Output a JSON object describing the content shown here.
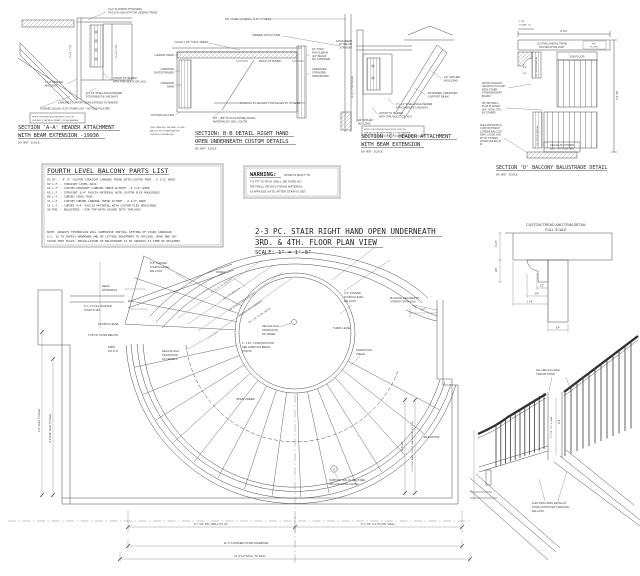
{
  "colors": {
    "ink": "#3f3f3f",
    "paper": "#ffffff"
  },
  "sa": {
    "t1": "SECTION 'A-A' HEADER ATTACHMENT",
    "t2": "WITH BEAM EXTENSION -19936",
    "scale": "DO NOT SCALE",
    "flooring": [
      "3-1/4\" FLOORING THICKNESS",
      "THIS IS FLUSH WITH TOP LANDING TREAD"
    ],
    "molding": [
      "1 1/2\" APPLIED",
      "MOLDING"
    ],
    "attach": [
      "ATTACH TO HEADER",
      "WITH THRU BOLTS OR LAGS"
    ],
    "angle": [
      "2\" x 1/4\" STEEL ANGLE HEADER",
      "ATTACHMENT BY ARCWAYS"
    ],
    "beam": "LAMINATED SUPPORT BEAM EXTENDS TO HEADER",
    "ceiling": "FINISHED CEILING IS BY OTHERS (3/4\" - 5/8\" PLUS PLASTER)",
    "note": [
      "NOTE: PROVIDE ACCESS AT FLOOR OR",
      "CEILING TO ATTACH STAIR TO THE HEADER"
    ],
    "dim1": "16 1/4\" (TYP)",
    "dim2": "15 1/2\" (TYP)"
  },
  "sb": {
    "t1": "SECTION: B-B DETAIL RIGHT HAND",
    "t2": "OPEN UNDERNEATH CUSTOM DETAILS",
    "scale": "DO NOT SCALE",
    "fin_panel": "FIN. PANEL MATERIAL IS BY OTHERS",
    "veneer": "VENEER TOP NO TRIM",
    "solid": "SOLID 1 1/4\" THICK TREAD",
    "back": "BACK OF RISER",
    "furring": "FURRING BY ARCWAYS INSTALLED BY OTHERS",
    "plaster": [
      "3/4\" - (5/8\" PLUS PLASTER) FINISH",
      "MATERIAL BY GEN. CONTR."
    ],
    "landing": "LANDING TREAD",
    "skirt": [
      "LAMINATED",
      "SKIRT/STRINGER"
    ],
    "beam": [
      "LAMINATED",
      "BEAM"
    ],
    "flex": "CUSTOM FLEX TRIM",
    "loose": [
      "THIS TRIM WILL BE SENT LOOSE",
      "AND FIT BY OTHERS AFTER",
      "CEILING IS INSTALLED"
    ],
    "fascia": [
      "3/4\" THICK",
      "FASCIA BEAM",
      "(1/2\" BELOW",
      "FIN. STRINGER)"
    ],
    "stringer": [
      "LAMINATED",
      "STRINGER/",
      "SKIRTBOARD"
    ]
  },
  "sc": {
    "t1": "SECTION 'C' HEADER ATTACHMENT",
    "t2": "WITH BEAM EXTENSION",
    "scale": "DO NOT SCALE",
    "fascia": [
      "FASCIA BEAM",
      "1/2\" BELOW",
      "STRINGER"
    ],
    "applied1": [
      "1/2\" APPLIED",
      "MOULDING"
    ],
    "extended": [
      "EXTENDED LAMINATED",
      "SUPPORT BEAM"
    ],
    "angle": [
      "2\" x 1/4\" STEEL ANGLE HEADER",
      "ATTACHMENT BY ARCWAYS"
    ],
    "attach": [
      "ATTACH TO HEADER",
      "WITH THRU BOLTS OR LAGS"
    ],
    "applied2": [
      "1/2\" APPLIED",
      "MOULDING"
    ],
    "note": [
      "NOTE: PROVIDE ACCESS AT FLOOR OR",
      "CEILING TO ATTACH STAIR TO THE HEADER"
    ],
    "dim": "11 1/2\" (TYP) CEILING"
  },
  "sd": {
    "t1": "SECTION 'D' BALCONY BALUSTRADE DETAIL",
    "scale": "DO NOT SCALE",
    "tread": [
      "CUSTOM LANDING TREAD",
      "ROUTED AT BALCONY"
    ],
    "fin_floor": [
      "FIN.",
      "FLOOR"
    ],
    "sub_floor": "SUB FLOOR",
    "fascia": [
      "WOOD FASCIA BY",
      "ARCWAYS IS FLUSH",
      "WITH OTHER",
      "STRINGER/SKIRT",
      "BOARD"
    ],
    "drywall": [
      "5/8\" DRYWALL",
      "PLUS PLASTER",
      "(3/4\" TOTAL TYP.)",
      "BY OTHERS"
    ],
    "flex": [
      "FLEX MOULDING &",
      "CUSTOM TRIM AT",
      "CORNER BALCONY",
      "SENT LOOSE JOB",
      "FIT BY OTHERS",
      "AFTER CEILING IS",
      "IN"
    ],
    "ceiling": [
      "CEILING BY OTHERS",
      "(5/8\" - 3/4\" PLASTER)"
    ],
    "wood_fascia": "3/4\" WOOD FASCIA",
    "dim_w": "8 1/4\"",
    "dim_bal": [
      "2 7/8\"",
      "TO BAL. C/L"
    ],
    "dim_h": "2'-9 7/8\"",
    "dim_s1": "5/8\"",
    "dim_s2": "3/4\""
  },
  "parts": {
    "title": "FOURTH LEVEL BALCONY PARTS LIST",
    "items": [
      "01 PC.  -  4' 0\" CUSTOM STRAIGHT LANDING TREAD WITH CUSTOM TRIM  -  6 1/2\" WIDE",
      "02 L.F. -  STRAIGHT LEVEL RAIL",
      "02 L.F. -  CUSTOM STRAIGHT LANDING TREAD W/TRIM  -  5 1/2\" WIDE",
      "02 L.F. -  STRAIGHT 3/4\" FASCIA MATERIAL WITH CUSTOM FLEX MOULDINGS",
      "06 L.F. -  CURVED LEVEL RAIL",
      "11 L.F. -  CUSTOM CURVED LANDING TREAD W/TRIM  -  6 1/2\" WIDE",
      "11 L.F. -  CURVED 3/4\" FASCIA MATERIAL WITH CUSTOM FLEX MOULDINGS",
      "30 POS. -  BALUSTERS : PIN TOP WITH LAGGED INTO TAPLOCKS"
    ],
    "notes": [
      "NOTE:  ARCWAYS TECHNICIAN WILL SUPERVISE INITIAL SETTING OF STAIR CARRIAGE",
      "G.C. IS TO SUPPLY MANPOWER AND OR LIFTING EQUIPMENT TO OFFLOAD, MOVE AND SET",
      "STAIR INTO PLACE.  INSTALLATION OF BALUSTRADE IS BY ARCWAYS AT TIME OF DELIVERY"
    ]
  },
  "warn": {
    "head": "WARNING:",
    "l1": "STAIR IS BUILT TO",
    "l2": "TO FIT TO RGH. WALL.  BE SURE NO",
    "l3": "DRYWALL OR ANY FINISH MATERIAL",
    "l4": "IS APPLIED UNTIL AFTER STAIR IS SET."
  },
  "title": {
    "l1": "2-3 PC. STAIR RIGHT HAND OPEN UNDERNEATH",
    "l2": "3RD. & 4TH. FLOOR PLAN VIEW",
    "l3": "SCALE: 1\" = 1'-0\""
  },
  "td": {
    "t1": "CUSTOM TREAD AND TRIM DETAIL",
    "t2": "FULL SCALE",
    "d1": "1 1/4\"",
    "d2": "3/4\"",
    "d3": "1/2\"",
    "d4": "3/4\"",
    "d5": "1 1/4\"",
    "d6": "3/4\""
  },
  "plan": {
    "balcony_left": [
      "8'-8\" CURVED",
      "FOURTH LEVEL",
      "BALCONY"
    ],
    "open_top": "OPEN",
    "beam_ext": [
      "BEAM",
      "EXTENSION"
    ],
    "gc_fill": [
      "G.C. TO FILL IN AFTER",
      "STAIR IS SET"
    ],
    "fourth_level": "FOURTH LEVEL",
    "top_of_stair": "TOP OF STAIR BELOW",
    "stair_no": [
      "19957",
      "DN 17 R"
    ],
    "helical1": [
      "HELICAL RAIL",
      "TRANSITION",
      "NO NEWELS"
    ],
    "helical2": [
      "HELICAL RAIL",
      "TRANSITION",
      "NO NEWEL"
    ],
    "construction": [
      "2 - 3 PC. CONSTRUCTION",
      "SEE JAMB FOR BREAK",
      "POINTS"
    ],
    "open_under": "OPEN UNDER",
    "r1": "R4'-10 1/4\" TO MOLDING",
    "r2": "R4'-7\" TO WALL C/L",
    "r3": "R4'-10 3/4\" TO RGH. BALCONY",
    "r4": "FRAMING PER DRAWINGS",
    "r5": "R5'-1 1/2\" TO FIN. FASCIA",
    "balcony_right": [
      "3'-0\" CURVED",
      "FOURTH LEVEL",
      "BALCONY"
    ],
    "blocking": [
      "BLOCKING REQUIRED BY",
      "OTHERS FOR NAILING"
    ],
    "third_level": "THIRD LEVEL",
    "transition": [
      "TRANSITION",
      "TREAD"
    ],
    "dim_12": "1'-2\"",
    "support": [
      "SUPPORT WALLS ARE STEEL",
      "WITH WOOD BLOCKING"
    ],
    "marker_b": "B",
    "elevator": "ELEVATOR",
    "dim_b1": "5'-7 1/2\" FIN. WALL TO C/L",
    "dim_b2": "5'-7 1/2\" C/L TO FIN. WALL",
    "dim_b3": "11'-3\" FINISHED STAIR DIAMETER",
    "dim_b4": "11'-4 1/2\" RGH. TO RGH.",
    "dim_l1": "9'-4\" RGH. TO RGH.",
    "dim_l2": "4'-8 9/16\" RGH. TO RGH.",
    "dim_r1": "9'-6 1/2\"",
    "dim_r2": "5'-7\" RGH. WALL TO RGH. BALCONY AT 4TH FLR."
  },
  "elev": {
    "helical": [
      "ALL HELICAL RAIL",
      "TRANSITIONS"
    ],
    "flex": [
      "FLEX MOULDING DETAIL AT",
      "STAIR CONTINUES THROUGH",
      "BALCONY"
    ],
    "dim1": "3'-6\"",
    "dim2": "1'-5 7/8\" TO T.O. RAIL"
  }
}
